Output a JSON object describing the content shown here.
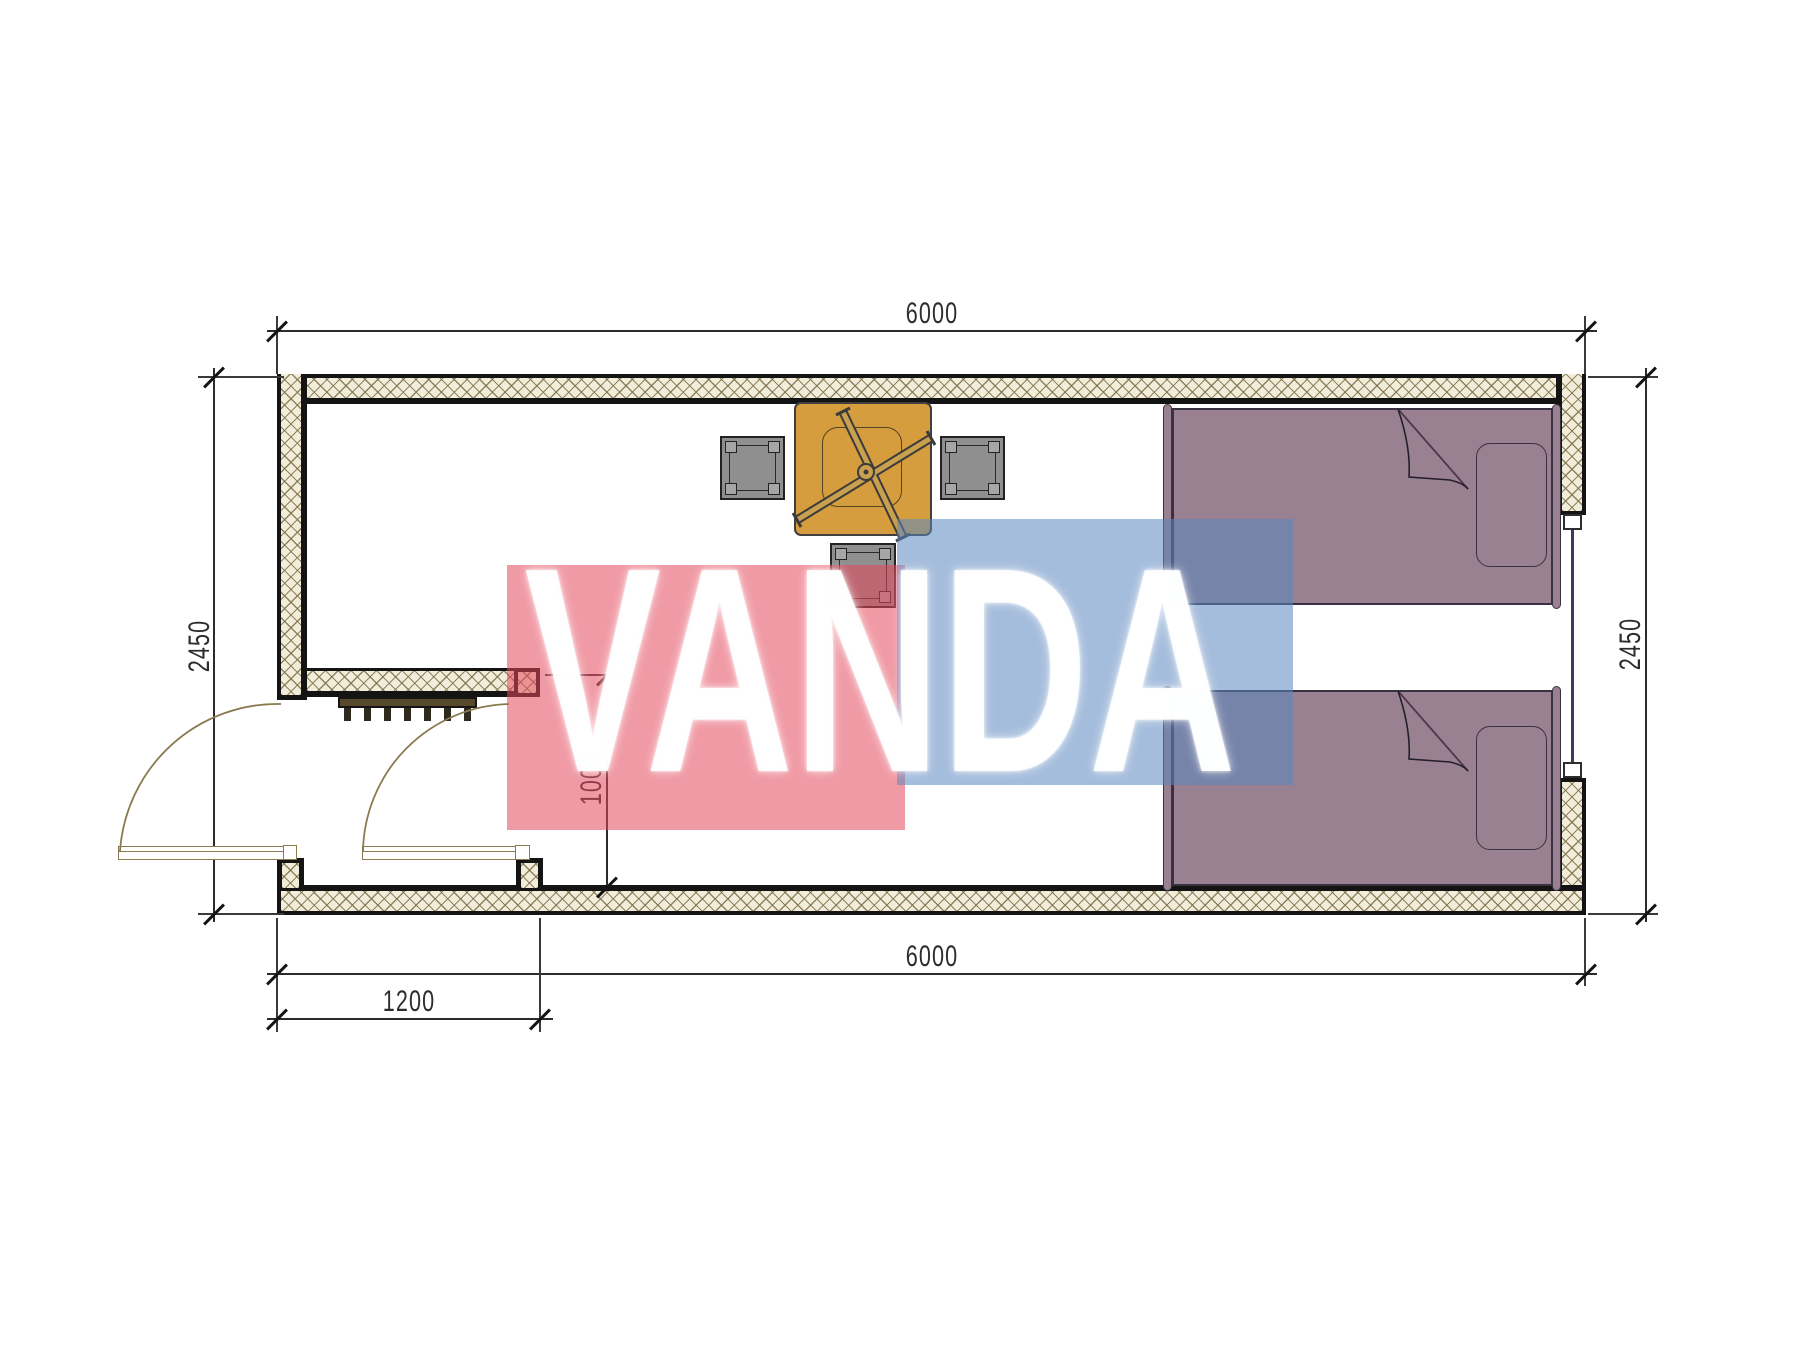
{
  "drawing": {
    "kind": "container-house-floor-plan",
    "room_count": 1
  },
  "dimensions": {
    "width_top": "6000",
    "width_bottom": "6000",
    "height_left": "2450",
    "height_right": "2450",
    "entry_width": "1200",
    "entry_depth": "1000"
  },
  "watermark": {
    "text": "VANDA",
    "red_color": "#e4475b",
    "blue_color": "#5b87bf",
    "text_color": "#ffffff",
    "opacity": 0.55
  },
  "palette": {
    "wall_line": "#141414",
    "wall_hatch_bg": "#f2edda",
    "wall_hatch_line": "#7d704a",
    "dimension_line": "#2c2c2c",
    "table_top": "#d59d3e",
    "table_frame": "#c9a04e",
    "stool": "#8f8f8f",
    "bed": "#9a8191",
    "bed_fold_line": "#4e3748",
    "door_swing_line": "#8a7a50",
    "doormat": "#57492c",
    "window_glass_line": "#3b3b5e"
  },
  "furniture": [
    {
      "name": "dining-table",
      "color": "#d59d3e"
    },
    {
      "name": "stool-left",
      "color": "#8f8f8f"
    },
    {
      "name": "stool-right",
      "color": "#8f8f8f"
    },
    {
      "name": "stool-bottom",
      "color": "#8f8f8f"
    },
    {
      "name": "single-bed-top",
      "color": "#9a8191"
    },
    {
      "name": "single-bed-bottom",
      "color": "#9a8191"
    },
    {
      "name": "doormat",
      "color": "#57492c"
    },
    {
      "name": "double-entry-door",
      "color": "#8a7a50"
    },
    {
      "name": "window-right-wall",
      "color": "#3b3b5e"
    }
  ]
}
